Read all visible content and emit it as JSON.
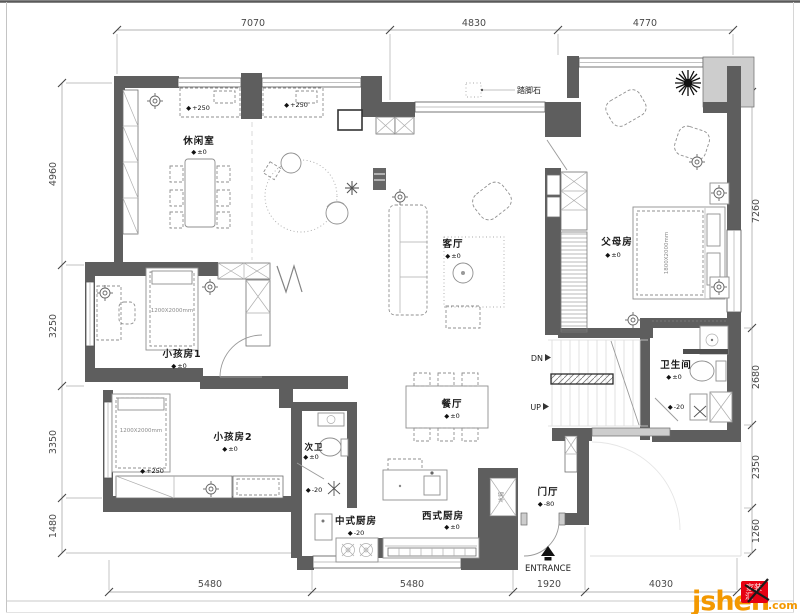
{
  "dims": {
    "top": [
      "7070",
      "4830",
      "4770"
    ],
    "left": [
      "4960",
      "3250",
      "3350",
      "1480"
    ],
    "right": [
      "7260",
      "2680",
      "2350",
      "1260"
    ],
    "bottom": [
      "5480",
      "5480",
      "1920",
      "4030"
    ]
  },
  "rooms": {
    "leisure": {
      "name": "休闲室",
      "level": "±0"
    },
    "living": {
      "name": "客厅",
      "level": "±0"
    },
    "parents": {
      "name": "父母房",
      "level": "±0"
    },
    "kid1": {
      "name": "小孩房1",
      "level": "±0"
    },
    "kid2": {
      "name": "小孩房2",
      "level": "±0"
    },
    "bath2": {
      "name": "次卫",
      "level": "±0"
    },
    "dining": {
      "name": "餐厅",
      "level": "±0"
    },
    "kitchen_west": {
      "name": "西式厨房",
      "level": "±0"
    },
    "kitchen_cn": {
      "name": "中式厨房",
      "level": "-20"
    },
    "foyer": {
      "name": "门厅",
      "level": "-80"
    },
    "bath_main": {
      "name": "卫生间",
      "level": "±0"
    }
  },
  "ann": {
    "marker": "◆",
    "plus250": "+250",
    "minus20": "-20",
    "kid_bed": "1200X2000mm",
    "parent_bed": "1800X2000mm",
    "fridge": "冰箱",
    "stepping_stone": "踏脚石",
    "dn": "DN",
    "up": "UP",
    "entrance": "ENTRANCE"
  },
  "logo": {
    "brand": "jsheh",
    "tld": ".com",
    "seal_top": "家装",
    "seal_bottom": "汇",
    "brand_color": "#f39800",
    "seal_color": "#e60012"
  }
}
